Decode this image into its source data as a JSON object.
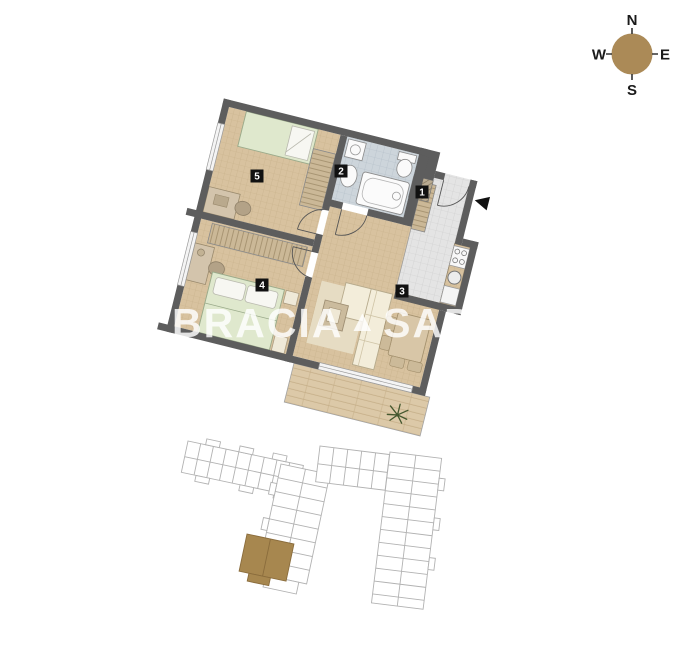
{
  "compass": {
    "north": "N",
    "east": "E",
    "south": "S",
    "west": "W",
    "disc_color": "#ab8a57"
  },
  "watermark": {
    "brand_left": "BRACIA",
    "brand_logo": "▲",
    "brand_right": "SADURSCY"
  },
  "rooms": [
    {
      "number": "1"
    },
    {
      "number": "2"
    },
    {
      "number": "3"
    },
    {
      "number": "4"
    },
    {
      "number": "5"
    }
  ],
  "colors": {
    "wall": "#5d5d5d",
    "floor_wood": "#d8c29f",
    "floor_bathroom": "#cdd5db",
    "floor_entry": "#e4e4e4",
    "terrace": "#dcc9a8",
    "site_outline": "#b2b2b2",
    "highlighted_unit": "#a7874f"
  }
}
